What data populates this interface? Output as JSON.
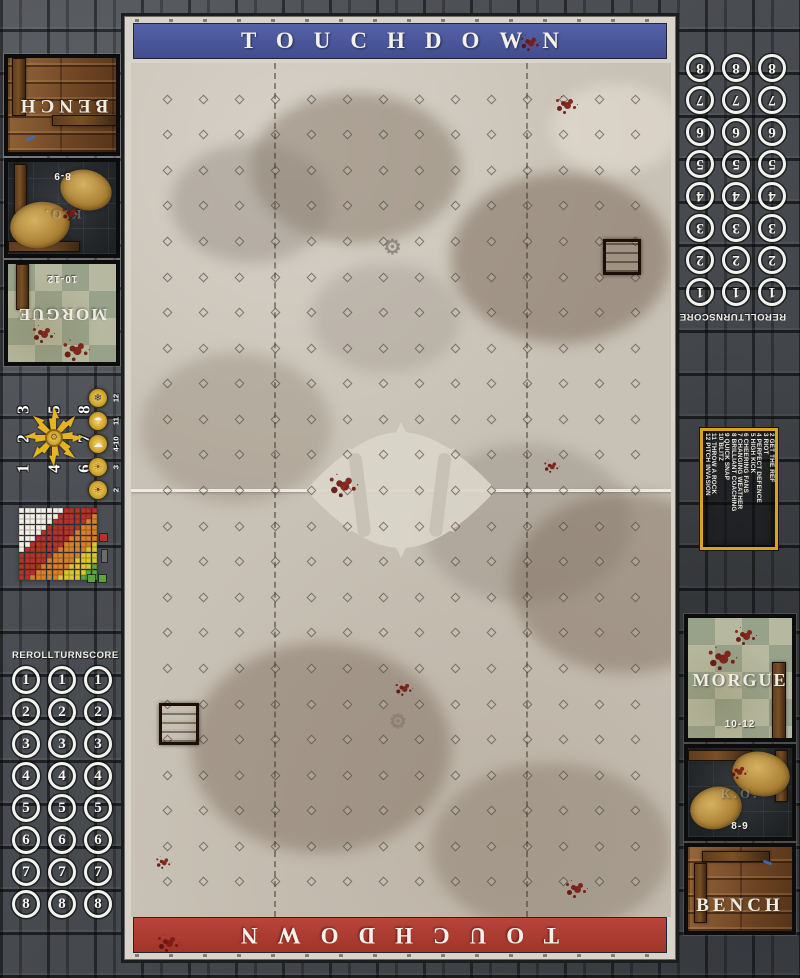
{
  "mat": {
    "top_banner": "TOUCHDOWN",
    "bottom_banner": "TOUCHDOWN"
  },
  "dugout": {
    "bench": "BENCH",
    "ko": "K.O.",
    "ko_range": "8-9",
    "morgue": "MORGUE",
    "morgue_range": "10-12"
  },
  "tracker": {
    "headers": [
      "REROLL",
      "TURN",
      "SCORE"
    ],
    "turns": [
      1,
      2,
      3,
      4,
      5,
      6,
      7,
      8
    ],
    "columns": 3
  },
  "scatter_template": {
    "grid": [
      [
        "3",
        "5",
        "8"
      ],
      [
        "2",
        "",
        "7"
      ],
      [
        "1",
        "4",
        "6"
      ]
    ]
  },
  "weather_table": [
    {
      "roll": "12",
      "icon": "blizzard-icon",
      "glyph": "❄",
      "glyph_color": "#2e3550"
    },
    {
      "roll": "11",
      "icon": "pouring-rain-icon",
      "glyph": "☂",
      "glyph_color": "#eef0f4"
    },
    {
      "roll": "4-10",
      "icon": "nice-weather-icon",
      "glyph": "☁",
      "glyph_color": "#f5f2e4"
    },
    {
      "roll": "3",
      "icon": "very-sunny-icon",
      "glyph": "☀",
      "glyph_color": "#8a5d10"
    },
    {
      "roll": "2",
      "icon": "sweltering-heat-icon",
      "glyph": "☀",
      "glyph_color": "#7a3c0c"
    }
  ],
  "kickoff_table": [
    "2 GET THE REF",
    "3 RIOT",
    "4 PERFECT DEFENCE",
    "5 HIGH KICK",
    "6 CHEERING FANS",
    "7 CHANGING WEATHER",
    "8 BRILLIANT COACHING",
    "9 QUICK SNAP",
    "10 BLITZ",
    "11 THROW A ROCK",
    "12 PITCH INVASION"
  ],
  "range_ruler": {
    "cols": 14,
    "rows": 13,
    "bands": [
      {
        "name": "quick-pass",
        "color": "#f3efe6",
        "max": 7
      },
      {
        "name": "short-pass",
        "color": "#b2352b",
        "max": 13
      },
      {
        "name": "long-pass",
        "color": "#d6822d",
        "max": 18
      },
      {
        "name": "long-bomb",
        "color": "#dcc634",
        "max": 22
      },
      {
        "name": "out-of-range",
        "color": "#5ba442",
        "max": 99
      }
    ]
  },
  "pitch": {
    "cols": 15,
    "rows": 24,
    "wide_zone_cols": 4
  },
  "colors": {
    "banner_blue": "#4a5698",
    "banner_red": "#b23c30",
    "frame": "#d9d5cb",
    "compass_yellow": "#e6b41f",
    "kickoff_border": "#d9a31b",
    "blood": "#70140e"
  }
}
